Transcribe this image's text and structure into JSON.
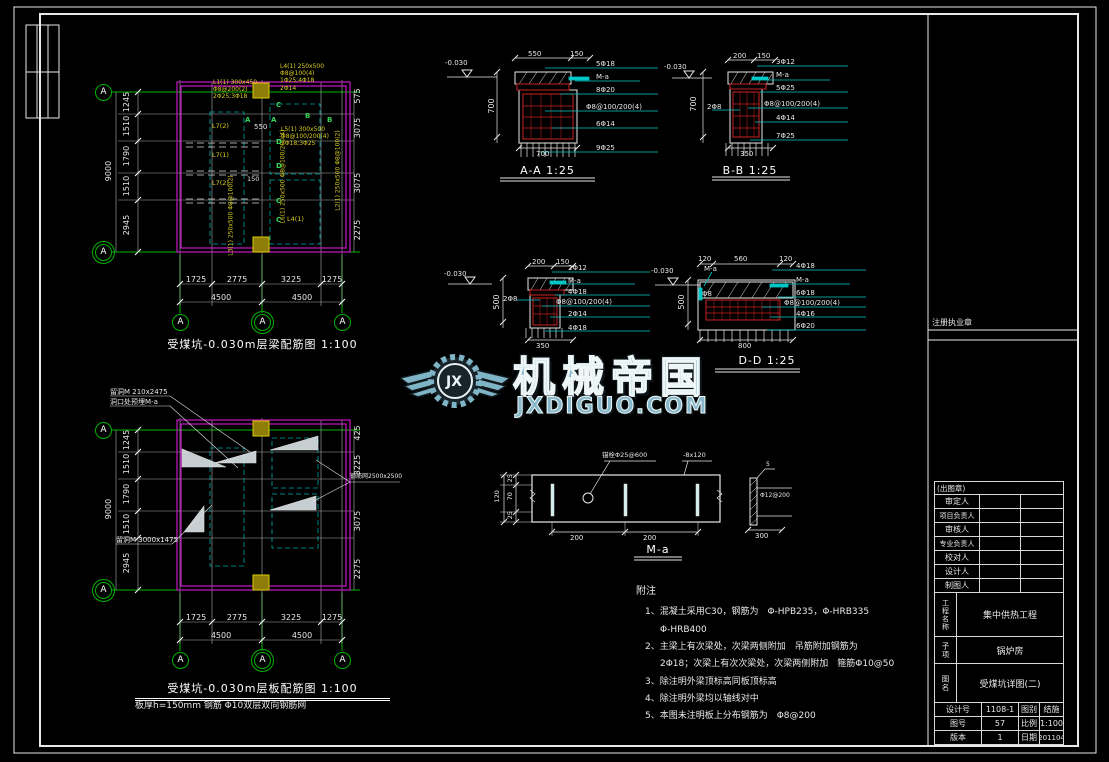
{
  "watermark": {
    "brand": "机械帝国",
    "domain": "JXDIGUO.COM",
    "logo_text": "JX"
  },
  "axis": {
    "bubble": "A"
  },
  "plan1": {
    "title": "受煤坑-0.030m层梁配筋图 1:100",
    "dims_left": [
      "1245",
      "1510",
      "1790",
      "1510",
      "2945"
    ],
    "dim_total": "9000",
    "dims_right": [
      "575",
      "3075",
      "3075",
      "2275"
    ],
    "dims_bottom": [
      "1725",
      "2775",
      "3225",
      "1275"
    ],
    "dims_bottom2": [
      "4500",
      "4500"
    ],
    "beams": {
      "b1": "L7(2)",
      "b2": "L7(1)",
      "b3": "L7(2)",
      "b4": "L4(1)",
      "d1": "550",
      "d2": "150"
    },
    "callout1": [
      "L1(1) 300x450",
      "Φ8@200(2)",
      "2Φ25;3Φ18"
    ],
    "callout2": [
      "L4(1) 250x500",
      "Φ8@100(4)",
      "1Φ25;4Φ18",
      "2Φ14"
    ],
    "callout3": [
      "L5(1) 300x500",
      "Φ8@100/200(4)",
      "2Φ18;3Φ25"
    ],
    "callout4": "L6(1) 250x500 Φ8@100/200(4)",
    "callout5": "L2(1) 250x500 Φ8@100(2)",
    "callout6": "L3(1) 250x500 Φ8@100(2)",
    "marks": {
      "a1": "A",
      "a2": "A",
      "b1": "B",
      "b2": "B",
      "c1": "C",
      "c2": "C",
      "c3": "C",
      "d1": "D",
      "d2": "D"
    }
  },
  "plan2": {
    "title": "受煤坑-0.030m层板配筋图 1:100",
    "note": "板厚h=150mm 钢筋 Φ10双层双向钢筋网",
    "dims_left": [
      "1245",
      "1510",
      "1790",
      "1510",
      "2945"
    ],
    "dim_total": "9000",
    "dims_right": [
      "425",
      "3225",
      "3075",
      "2275"
    ],
    "dims_bottom": [
      "1725",
      "2775",
      "3225",
      "1275"
    ],
    "dims_bottom2": [
      "4500",
      "4500"
    ],
    "ann1": "留洞M 210x2475",
    "ann2": "洞口处预埋M-a",
    "ann3": "留洞M 3000x1475",
    "ann4": "钢筋网2500x2500"
  },
  "sections": {
    "aa": {
      "title": "A-A 1:25",
      "elev": "-0.030",
      "top1": "550",
      "top2": "150",
      "height": "700",
      "bottom": "700",
      "labels": [
        "5Φ18",
        "M-a",
        "8Φ20",
        "Φ8@100/200(4)",
        "6Φ14",
        "9Φ25"
      ]
    },
    "bb": {
      "title": "B-B 1:25",
      "elev": "-0.030",
      "top1": "200",
      "top2": "150",
      "height": "700",
      "bottom": "350",
      "left": "2Φ8",
      "labels": [
        "3Φ12",
        "M-a",
        "5Φ25",
        "Φ8@100/200(4)",
        "4Φ14",
        "7Φ25"
      ]
    },
    "cc": {
      "elev": "-0.030",
      "top1": "200",
      "top2": "150",
      "height": "500",
      "bottom": "350",
      "left": "2Φ8",
      "labels": [
        "2Φ12",
        "M-a",
        "4Φ18",
        "Φ8@100/200(4)",
        "2Φ14",
        "4Φ18"
      ]
    },
    "dd": {
      "title": "D-D 1:25",
      "elev": "-0.030",
      "top1": "120",
      "top2": "560",
      "top3": "120",
      "height": "500",
      "bottom": "800",
      "left1": "M-a",
      "left2": "Φ8",
      "labels": [
        "4Φ18",
        "M-a",
        "6Φ18",
        "Φ8@100/200(4)",
        "4Φ16",
        "6Φ20"
      ]
    }
  },
  "detail": {
    "title": "M-a",
    "anchor": "锚栓Φ25@600",
    "plate": "-8x120",
    "d25a": "25",
    "d70": "70",
    "d25b": "25",
    "d120": "120",
    "d200a": "200",
    "d200b": "200",
    "weld": "5",
    "bar": "Φ12@200",
    "d300": "300"
  },
  "notes": {
    "title": "附注",
    "lines": [
      "1、混凝土采用C30，钢筋为　Φ-HPB235，Φ-HRB335",
      "Φ-HRB400",
      "2、主梁上有次梁处，次梁两侧附加　吊筋附加钢筋为",
      "2Φ18；次梁上有次次梁处，次梁两侧附加　箍筋Φ10@50",
      "3、除注明外梁顶标高同板顶标高",
      "4、除注明外梁均以轴线对中",
      "5、本图未注明板上分布钢筋为　Φ8@200"
    ]
  },
  "titleblock": {
    "seal": "注册执业章",
    "stamp": "(出图章)",
    "people": [
      "审定人",
      "项目负责人",
      "审核人",
      "专业负责人",
      "校对人",
      "设计人",
      "制图人"
    ],
    "project_label": "工程名称",
    "project": "集中供热工程",
    "sub_label": "子项",
    "sub": "锅炉房",
    "name_label": "图名",
    "name": "受煤坑详图(二)",
    "design_label": "设计号",
    "design": "1108-1",
    "cat_label": "图别",
    "cat": "结施",
    "sheet_label": "图号",
    "sheet": "57",
    "scale_label": "比例",
    "scale": "1:100",
    "ver_label": "版本",
    "ver": "1",
    "date_label": "日期",
    "date": "201104"
  }
}
